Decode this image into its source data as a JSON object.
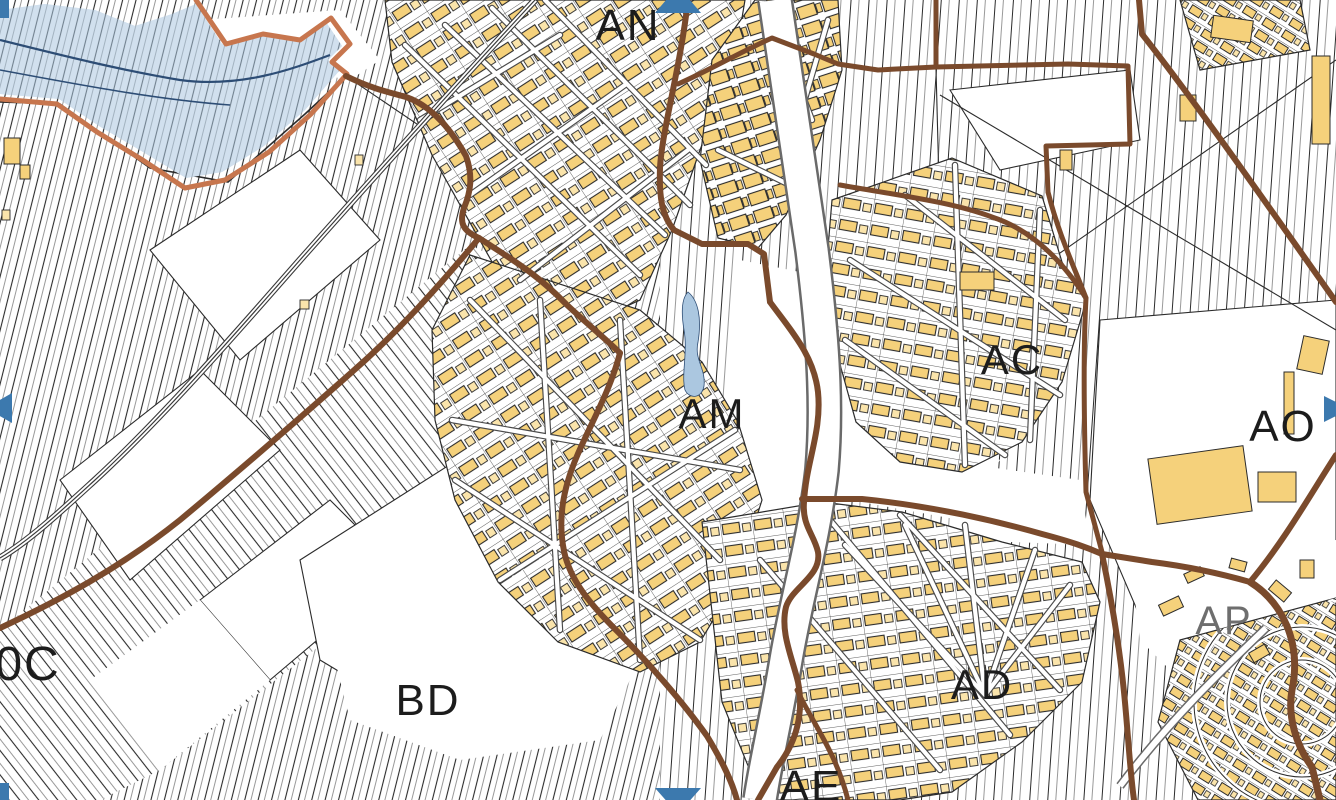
{
  "map": {
    "kind": "cadastral-parcel-map",
    "colors": {
      "background": "#ffffff",
      "parcel_line": "#2b2b2b",
      "building": "#f5d17b",
      "building_light": "#fae4ab",
      "section_boundary_brown": "#7a4a2c",
      "commune_boundary_orange": "#c7764e",
      "water_fill": "#abc7e0",
      "water_line": "#2d4d75",
      "edge_arrow_blue": "#3c79ae",
      "label_color": "#1c1c1c",
      "label_muted_color": "#6e6e6e"
    },
    "section_labels": [
      {
        "id": "AN",
        "x": 628,
        "y": 40,
        "size": 44,
        "muted": false
      },
      {
        "id": "AM",
        "x": 712,
        "y": 428,
        "size": 42,
        "muted": false
      },
      {
        "id": "AC",
        "x": 1012,
        "y": 374,
        "size": 42,
        "muted": false
      },
      {
        "id": "AO",
        "x": 1283,
        "y": 441,
        "size": 44,
        "muted": false
      },
      {
        "id": "AP",
        "x": 1224,
        "y": 634,
        "size": 40,
        "muted": true
      },
      {
        "id": "AD",
        "x": 982,
        "y": 699,
        "size": 42,
        "muted": false
      },
      {
        "id": "AE",
        "x": 811,
        "y": 801,
        "size": 44,
        "muted": false
      },
      {
        "id": "BD",
        "x": 428,
        "y": 715,
        "size": 44,
        "muted": false
      },
      {
        "id": "0C",
        "x": 28,
        "y": 680,
        "size": 48,
        "muted": false
      }
    ],
    "edge_arrows": [
      {
        "id": "pan-up",
        "direction": "up",
        "x": 678,
        "y": 0
      },
      {
        "id": "pan-left",
        "direction": "left",
        "x": 0,
        "y": 408
      },
      {
        "id": "pan-right",
        "direction": "right",
        "x": 1336,
        "y": 409
      },
      {
        "id": "pan-down",
        "direction": "down",
        "x": 678,
        "y": 800
      },
      {
        "id": "pan-corner-top-left",
        "direction": "corner",
        "x": 0,
        "y": 0
      },
      {
        "id": "pan-corner-bottom-left",
        "direction": "corner",
        "x": 0,
        "y": 783
      }
    ],
    "features": {
      "water_area": "lake-top-left",
      "pond": "small-pond-center",
      "railway": "railway-diagonal-left",
      "river_road": "white-corridor-center"
    }
  }
}
